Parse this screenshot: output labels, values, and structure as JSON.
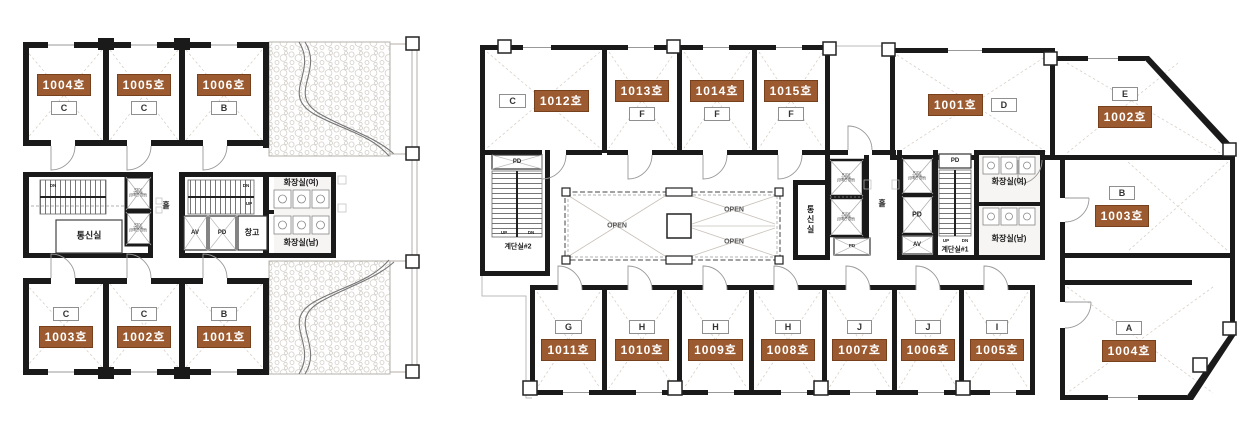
{
  "palette": {
    "badge_bg": "#9c5a30",
    "badge_border": "#76401c",
    "wall": "#1a1a1a",
    "thin_line": "#999999",
    "diagonal_line": "#d8cfc6",
    "type_box_border": "#8f8f8f"
  },
  "labels": {
    "pd": "PD",
    "av": "AV",
    "up": "UP",
    "dn": "DN",
    "open": "OPEN",
    "hall": "홀",
    "comm_room": "통신실",
    "storage": "창고",
    "wc_women": "화장실(여)",
    "wc_men": "화장실(남)",
    "stair1": "계단실#1",
    "stair2": "계단실#2",
    "ev_passenger": "P.EV\n15인승\n(장애인 겸용)",
    "ev_emergency": "R.EV\n17인승\n(장애인 겸용)"
  },
  "left_plan": {
    "top_rooms": [
      {
        "number": "1004호",
        "type": "C"
      },
      {
        "number": "1005호",
        "type": "C"
      },
      {
        "number": "1006호",
        "type": "B"
      }
    ],
    "bottom_rooms": [
      {
        "number": "1003호",
        "type": "C"
      },
      {
        "number": "1002호",
        "type": "C"
      },
      {
        "number": "1001호",
        "type": "B"
      }
    ]
  },
  "right_plan": {
    "top_rooms": [
      {
        "number": "1012호",
        "type": "C"
      },
      {
        "number": "1013호",
        "type": "F"
      },
      {
        "number": "1014호",
        "type": "F"
      },
      {
        "number": "1015호",
        "type": "F"
      },
      {
        "number": "1001호",
        "type": "D"
      },
      {
        "number": "1002호",
        "type": "E"
      }
    ],
    "side_room": {
      "number": "1003호",
      "type": "B"
    },
    "bottom_rooms": [
      {
        "number": "1011호",
        "type": "G"
      },
      {
        "number": "1010호",
        "type": "H"
      },
      {
        "number": "1009호",
        "type": "H"
      },
      {
        "number": "1008호",
        "type": "H"
      },
      {
        "number": "1007호",
        "type": "J"
      },
      {
        "number": "1006호",
        "type": "J"
      },
      {
        "number": "1005호",
        "type": "I"
      },
      {
        "number": "1004호",
        "type": "A"
      }
    ]
  }
}
